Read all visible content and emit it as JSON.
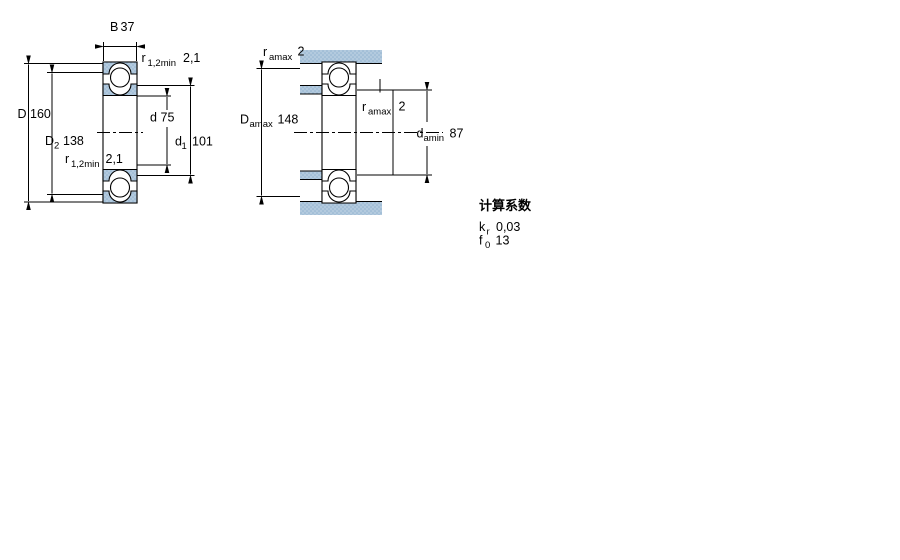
{
  "drawing_left": {
    "labels": {
      "B": {
        "sym": "B",
        "val": "37"
      },
      "D": {
        "sym": "D",
        "val": "160"
      },
      "D2": {
        "sym": "D",
        "sub": "2",
        "val": "138"
      },
      "d": {
        "sym": "d",
        "val": "75"
      },
      "d1": {
        "sym": "d",
        "sub": "1",
        "val": "101"
      },
      "r_top": {
        "sym": "r",
        "sub": "1,2min",
        "val": "2,1"
      },
      "r_bot": {
        "sym": "r",
        "sub": "1,2min",
        "val": "2,1"
      }
    }
  },
  "drawing_right": {
    "labels": {
      "r_amax_top": {
        "sym": "r",
        "sub": "amax",
        "val": "2"
      },
      "D_amax": {
        "sym": "D",
        "sub": "amax",
        "val": "148"
      },
      "r_amax_mid": {
        "sym": "r",
        "sub": "amax",
        "val": "2"
      },
      "d_amin": {
        "sym": "d",
        "sub": "amin",
        "val": "87"
      }
    }
  },
  "calc_factors": {
    "title": "计算系数",
    "rows": [
      {
        "sym": "k",
        "sub": "r",
        "val": "0,03"
      },
      {
        "sym": "f",
        "sub": "0",
        "val": "13"
      }
    ]
  },
  "colors": {
    "steel_base": "#b3cade",
    "steel_dot": "#8fb2cf",
    "line": "#000000",
    "background": "#ffffff"
  }
}
